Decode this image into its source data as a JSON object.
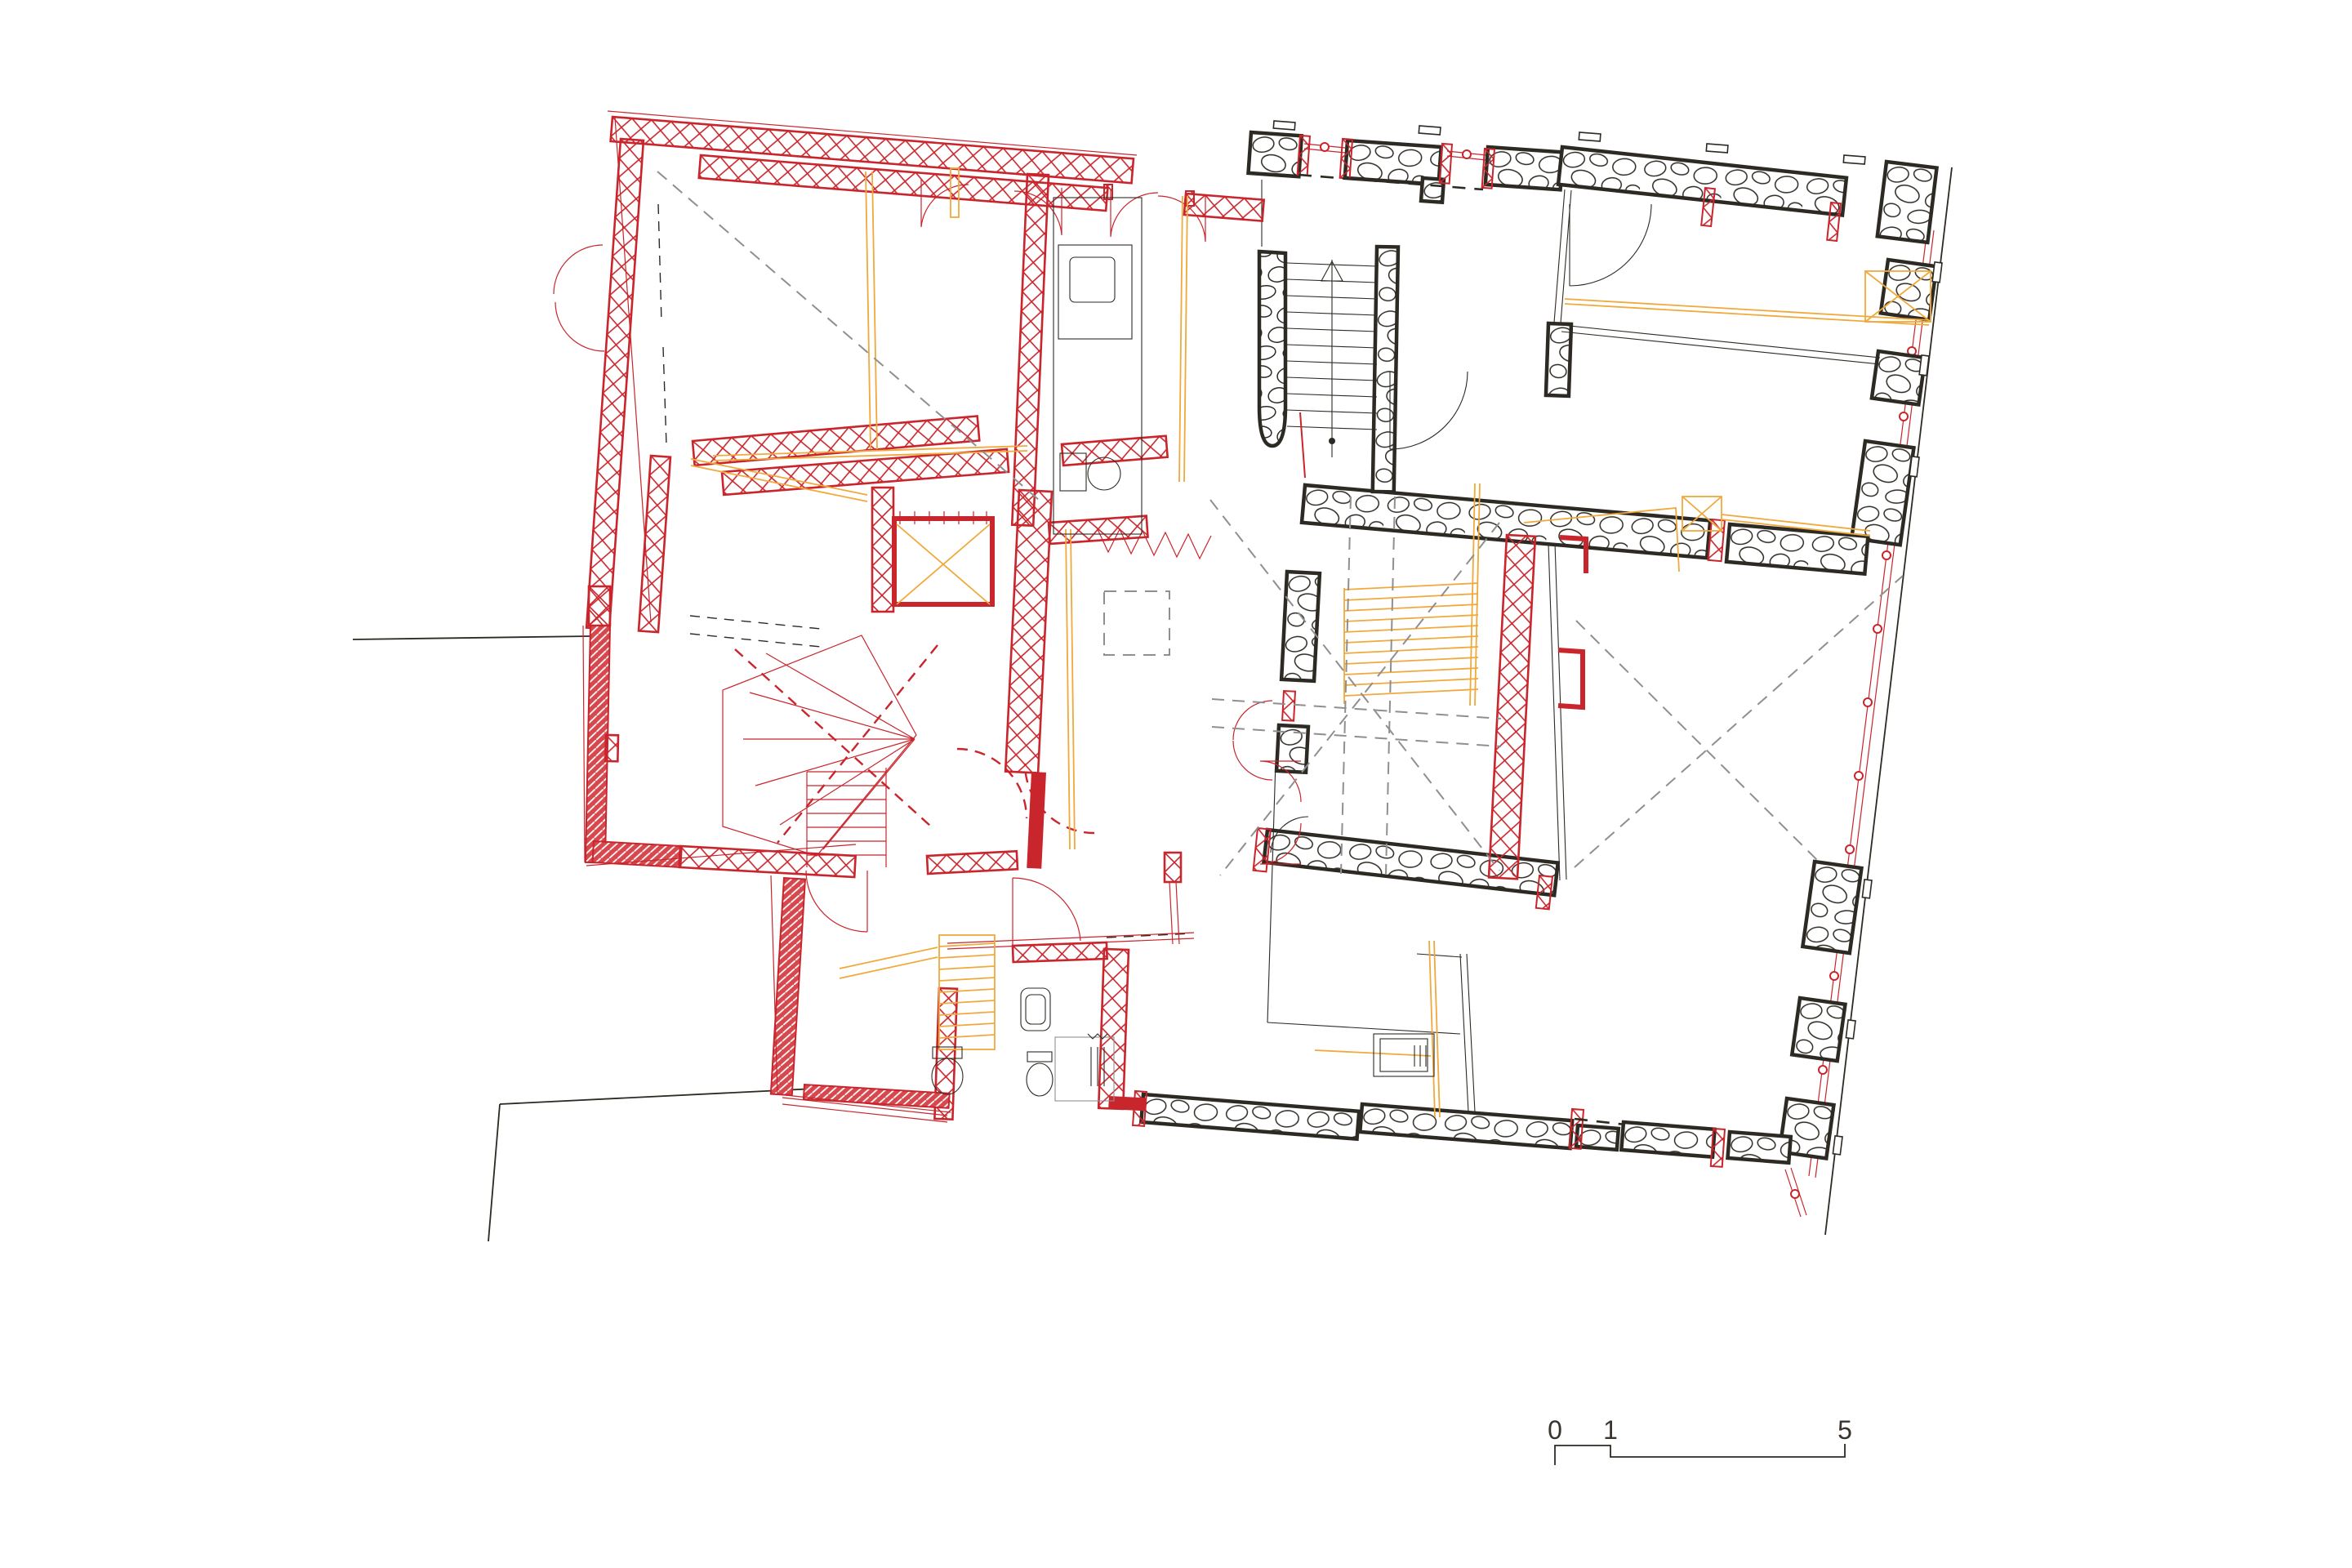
{
  "drawing": {
    "type": "architectural floor plan",
    "scale_bar": {
      "labels": [
        "0",
        "1",
        "5"
      ]
    }
  },
  "colors": {
    "red": "#c8252c",
    "red-mid": "#d6484e",
    "orange": "#f0a93b",
    "dark": "#2d2a23",
    "gray": "#8f8f8f",
    "text": "#3a342c",
    "paper": "#ffffff"
  }
}
